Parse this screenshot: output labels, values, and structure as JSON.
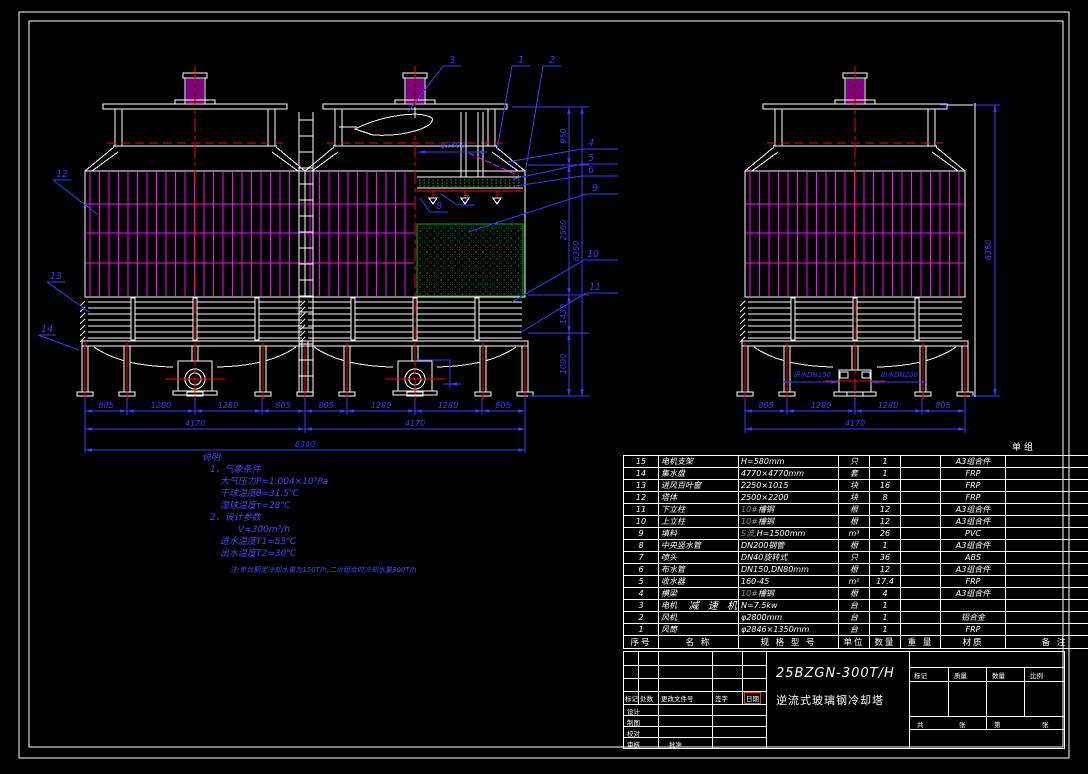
{
  "drawing": {
    "model": "25BZGN-300T/H",
    "name": "逆流式玻璃钢冷却塔",
    "unit_label": "单组"
  },
  "notes": {
    "lines": [
      "说明:",
      "1、气象条件",
      "大气压力P=1.004×10⁵Pa",
      "干球温度θ=31.5℃",
      "湿球温度τ=28℃",
      "2、设计参数",
      "V=300m³/h",
      "进水温度T1=55℃",
      "出水温度T2=30℃",
      "注:单台额定冷却水量为150T/h,二台组合时冷却水量300T/h"
    ]
  },
  "dims": {
    "front_bottom_row1": [
      "805",
      "1280",
      "1280",
      "805",
      "805",
      "1280",
      "1280",
      "805"
    ],
    "front_bottom_row2": [
      "4170",
      "4170"
    ],
    "front_bottom_total": "8340",
    "front_height_chain": [
      "950",
      "2500",
      "1430",
      "1000"
    ],
    "front_height_total": "6360",
    "fan_diameter": "φ2800",
    "side_bottom_row1": [
      "805",
      "1280",
      "1280",
      "805"
    ],
    "side_bottom_total": "4170",
    "side_height_total": "6360",
    "inlet_label": "进水DN150",
    "outlet_label": "出水DN200"
  },
  "balloons": [
    "3",
    "1",
    "2",
    "12",
    "13",
    "14",
    "4",
    "5",
    "6",
    "9",
    "10",
    "11",
    "7",
    "8"
  ],
  "parts_table": {
    "headers": [
      "序号",
      "名 称",
      "规 格 型 号",
      "单位",
      "数量",
      "重 量",
      "材质",
      "备 注"
    ],
    "rows": [
      {
        "no": "15",
        "name": "电机支架",
        "spec_pre": "",
        "spec": "H=580mm",
        "unit": "只",
        "qty": "1",
        "weight": "",
        "material": "A3组合件",
        "note": ""
      },
      {
        "no": "14",
        "name": "集水盘",
        "spec_pre": "",
        "spec": "4770×4770mm",
        "unit": "套",
        "qty": "1",
        "weight": "",
        "material": "FRP",
        "note": ""
      },
      {
        "no": "13",
        "name": "进风百叶窗",
        "spec_pre": "",
        "spec": "2250×1015",
        "unit": "块",
        "qty": "16",
        "weight": "",
        "material": "FRP",
        "note": ""
      },
      {
        "no": "12",
        "name": "塔体",
        "spec_pre": "",
        "spec": "2500×2200",
        "unit": "块",
        "qty": "8",
        "weight": "",
        "material": "FRP",
        "note": ""
      },
      {
        "no": "11",
        "name": "下立柱",
        "spec_pre": "10#",
        "spec": "槽钢",
        "unit": "根",
        "qty": "12",
        "weight": "",
        "material": "A3组合件",
        "note": ""
      },
      {
        "no": "10",
        "name": "上立柱",
        "spec_pre": "10#",
        "spec": "槽钢",
        "unit": "根",
        "qty": "12",
        "weight": "",
        "material": "A3组合件",
        "note": ""
      },
      {
        "no": "9",
        "name": "填料",
        "spec_pre": "S波,",
        "spec": "H=1500mm",
        "unit": "m³",
        "qty": "26",
        "weight": "",
        "material": "PVC",
        "note": ""
      },
      {
        "no": "8",
        "name": "中央竖水管",
        "spec_pre": "",
        "spec": "DN200钢管",
        "unit": "根",
        "qty": "1",
        "weight": "",
        "material": "A3组合件",
        "note": ""
      },
      {
        "no": "7",
        "name": "喷头",
        "spec_pre": "",
        "spec": "DN40旋转式",
        "unit": "只",
        "qty": "36",
        "weight": "",
        "material": "ABS",
        "note": ""
      },
      {
        "no": "6",
        "name": "布水管",
        "spec_pre": "",
        "spec": "DN150,DN80mm",
        "unit": "根",
        "qty": "12",
        "weight": "",
        "material": "A3组合件",
        "note": ""
      },
      {
        "no": "5",
        "name": "收水器",
        "spec_pre": "",
        "spec": "160-45",
        "unit": "m²",
        "qty": "17.4",
        "weight": "",
        "material": "FRP",
        "note": ""
      },
      {
        "no": "4",
        "name": "横梁",
        "spec_pre": "10#",
        "spec": "槽钢",
        "unit": "根",
        "qty": "4",
        "weight": "",
        "material": "A3组合件",
        "note": ""
      },
      {
        "no": "3",
        "name": "电机",
        "overlay": "减 速 机",
        "spec_pre": "",
        "spec": "N=7.5kw",
        "unit": "台",
        "qty": "1",
        "weight": "",
        "material": "",
        "note": ""
      },
      {
        "no": "2",
        "name": "风机",
        "spec_pre": "",
        "spec": "φ2800mm",
        "unit": "台",
        "qty": "1",
        "weight": "",
        "material": "铝合金",
        "note": ""
      },
      {
        "no": "1",
        "name": "风筒",
        "spec_pre": "",
        "spec": "φ2846×1350mm",
        "unit": "台",
        "qty": "1",
        "weight": "",
        "material": "FRP",
        "note": ""
      }
    ]
  },
  "title_block": {
    "left_headers": [
      "标记",
      "处数",
      "更改文件号",
      "签字",
      "日期"
    ],
    "row_labels": [
      "设计",
      "制图",
      "校对",
      "审核"
    ],
    "approve_label": "批准",
    "right_headers": [
      "标记",
      "质量",
      "数量",
      "比例"
    ],
    "sheet_labels": [
      "共",
      "张",
      "第",
      "张"
    ]
  },
  "colors": {
    "white": "#ffffff",
    "magenta": "#ff00ff",
    "red": "#ff0000",
    "blue": "#3a3aff",
    "green": "#00c800",
    "gray": "#909090",
    "highlight": "#c85000",
    "notes_blue": "#4747ff"
  }
}
